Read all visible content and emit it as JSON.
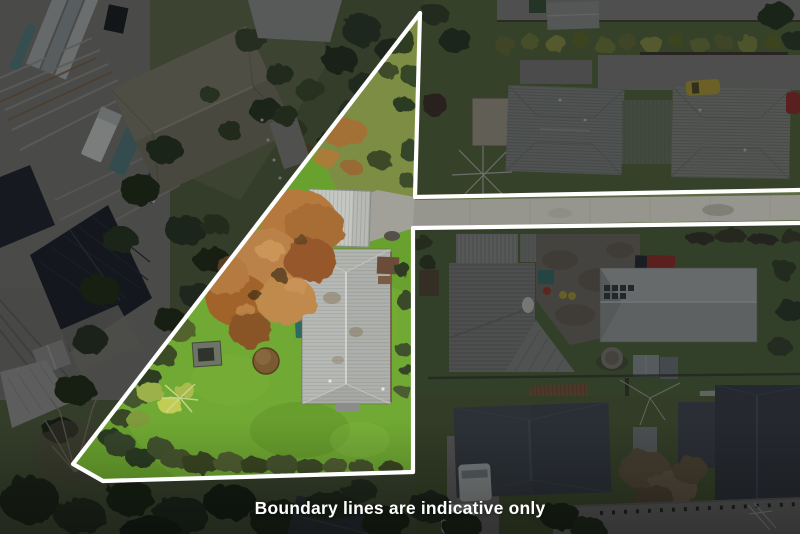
{
  "photo": {
    "kind": "aerial-drone-property-photo",
    "caption": "Boundary lines are indicative only"
  },
  "overlay": {
    "boundary_line_color": "#ffffff",
    "boundary_stroke_width": 4.2,
    "dim_color": "rgba(9,11,15,0.47)",
    "boundary_polyline": [
      [
        800,
        190
      ],
      [
        415,
        197
      ],
      [
        420,
        13
      ],
      [
        73,
        464
      ],
      [
        103,
        481
      ],
      [
        413,
        472
      ],
      [
        413,
        228
      ],
      [
        800,
        223
      ]
    ],
    "highlight_hole": [
      [
        420,
        13
      ],
      [
        415,
        197
      ],
      [
        800,
        190
      ],
      [
        800,
        223
      ],
      [
        413,
        228
      ],
      [
        413,
        472
      ],
      [
        103,
        481
      ],
      [
        73,
        464
      ]
    ],
    "property_polygon": [
      [
        420,
        13
      ],
      [
        415,
        197
      ],
      [
        413,
        228
      ],
      [
        413,
        472
      ],
      [
        103,
        481
      ],
      [
        73,
        464
      ]
    ]
  },
  "palette": {
    "lawn_bright": "#69a12e",
    "meadow": "#7e8d44",
    "autumn_tree": "#b5793c",
    "house_roof": "#b7b9b6",
    "road": "#97968e",
    "outside_lawn": "#5e7440",
    "industrial_roof": "#20242c"
  }
}
